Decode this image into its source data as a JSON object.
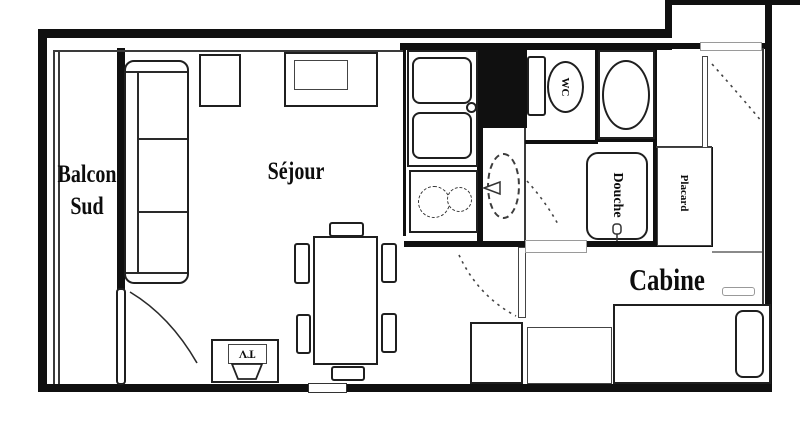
{
  "rooms": {
    "balcon": {
      "line1": "Balcon",
      "line2": "Sud"
    },
    "sejour": {
      "label": "Séjour"
    },
    "cabine": {
      "label": "Cabine"
    },
    "wc": {
      "label": "WC"
    },
    "douche": {
      "label": "Douche"
    },
    "placard": {
      "label": "Placard"
    }
  },
  "furniture": {
    "tv_label": "TV"
  },
  "colors": {
    "wall": "#101010",
    "line": "#2a2a2a",
    "background": "#ffffff"
  }
}
